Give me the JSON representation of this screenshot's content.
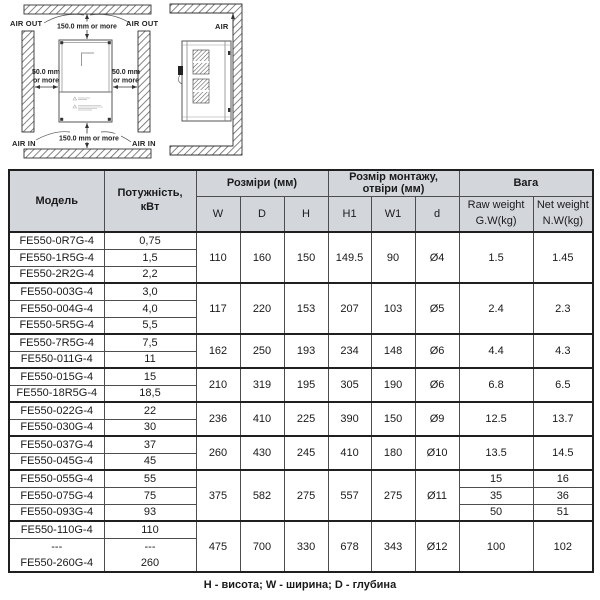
{
  "diagram": {
    "front": {
      "air_out_left": "AIR OUT",
      "air_out_right": "AIR OUT",
      "top_clearance": "150.0 mm or more",
      "left_clearance_line1": "50.0 mm",
      "left_clearance_line2": "or more",
      "right_clearance_line1": "50.0 mm",
      "right_clearance_line2": "or more",
      "bottom_clearance": "150.0 mm or more",
      "air_in_left": "AIR IN",
      "air_in_right": "AIR IN"
    },
    "side": {
      "air_label": "AIR"
    }
  },
  "table": {
    "headers": {
      "model": "Модель",
      "power": "Потужність,\nкВт",
      "dims_group": "Розміри (мм)",
      "dims": [
        "W",
        "D",
        "H"
      ],
      "mount_group": "Розмір монтажу, отвіри  (мм)",
      "mount": [
        "H1",
        "W1",
        "d"
      ],
      "weight_group": "Вага",
      "raw_weight": "Raw weight\nG.W(kg)",
      "net_weight": "Net weight\nN.W(kg)"
    },
    "groups": [
      {
        "rows": [
          [
            "FE550-0R7G-4",
            "0,75"
          ],
          [
            "FE550-1R5G-4",
            "1,5"
          ],
          [
            "FE550-2R2G-4",
            "2,2"
          ]
        ],
        "dims": [
          "110",
          "160",
          "150"
        ],
        "mount": [
          "149.5",
          "90",
          "Ø4"
        ],
        "weights": [
          [
            "1.5",
            "1.45"
          ]
        ]
      },
      {
        "rows": [
          [
            "FE550-003G-4",
            "3,0"
          ],
          [
            "FE550-004G-4",
            "4,0"
          ],
          [
            "FE550-5R5G-4",
            "5,5"
          ]
        ],
        "dims": [
          "117",
          "220",
          "153"
        ],
        "mount": [
          "207",
          "103",
          "Ø5"
        ],
        "weights": [
          [
            "2.4",
            "2.3"
          ]
        ]
      },
      {
        "rows": [
          [
            "FE550-7R5G-4",
            "7,5"
          ],
          [
            "FE550-011G-4",
            "11"
          ]
        ],
        "dims": [
          "162",
          "250",
          "193"
        ],
        "mount": [
          "234",
          "148",
          "Ø6"
        ],
        "weights": [
          [
            "4.4",
            "4.3"
          ]
        ]
      },
      {
        "rows": [
          [
            "FE550-015G-4",
            "15"
          ],
          [
            "FE550-18R5G-4",
            "18,5"
          ]
        ],
        "dims": [
          "210",
          "319",
          "195"
        ],
        "mount": [
          "305",
          "190",
          "Ø6"
        ],
        "weights": [
          [
            "6.8",
            "6.5"
          ]
        ]
      },
      {
        "rows": [
          [
            "FE550-022G-4",
            "22"
          ],
          [
            "FE550-030G-4",
            "30"
          ]
        ],
        "dims": [
          "236",
          "410",
          "225"
        ],
        "mount": [
          "390",
          "150",
          "Ø9"
        ],
        "weights": [
          [
            "12.5",
            "13.7"
          ]
        ]
      },
      {
        "rows": [
          [
            "FE550-037G-4",
            "37"
          ],
          [
            "FE550-045G-4",
            "45"
          ]
        ],
        "dims": [
          "260",
          "430",
          "245"
        ],
        "mount": [
          "410",
          "180",
          "Ø10"
        ],
        "weights": [
          [
            "13.5",
            "14.5"
          ]
        ]
      },
      {
        "rows": [
          [
            "FE550-055G-4",
            "55"
          ],
          [
            "FE550-075G-4",
            "75"
          ],
          [
            "FE550-093G-4",
            "93"
          ]
        ],
        "dims": [
          "375",
          "582",
          "275"
        ],
        "mount": [
          "557",
          "275",
          "Ø11"
        ],
        "weights": [
          [
            "15",
            "16"
          ],
          [
            "35",
            "36"
          ],
          [
            "50",
            "51"
          ]
        ]
      },
      {
        "rows": [
          [
            "FE550-110G-4",
            "110"
          ],
          [
            "---",
            "---"
          ],
          [
            "FE550-260G-4",
            "260"
          ]
        ],
        "dims": [
          "475",
          "700",
          "330"
        ],
        "mount": [
          "678",
          "343",
          "Ø12"
        ],
        "weights": [
          [
            "100",
            "102"
          ]
        ]
      }
    ],
    "footnote": "Н - висота; W - ширина;  D -  глубина"
  }
}
